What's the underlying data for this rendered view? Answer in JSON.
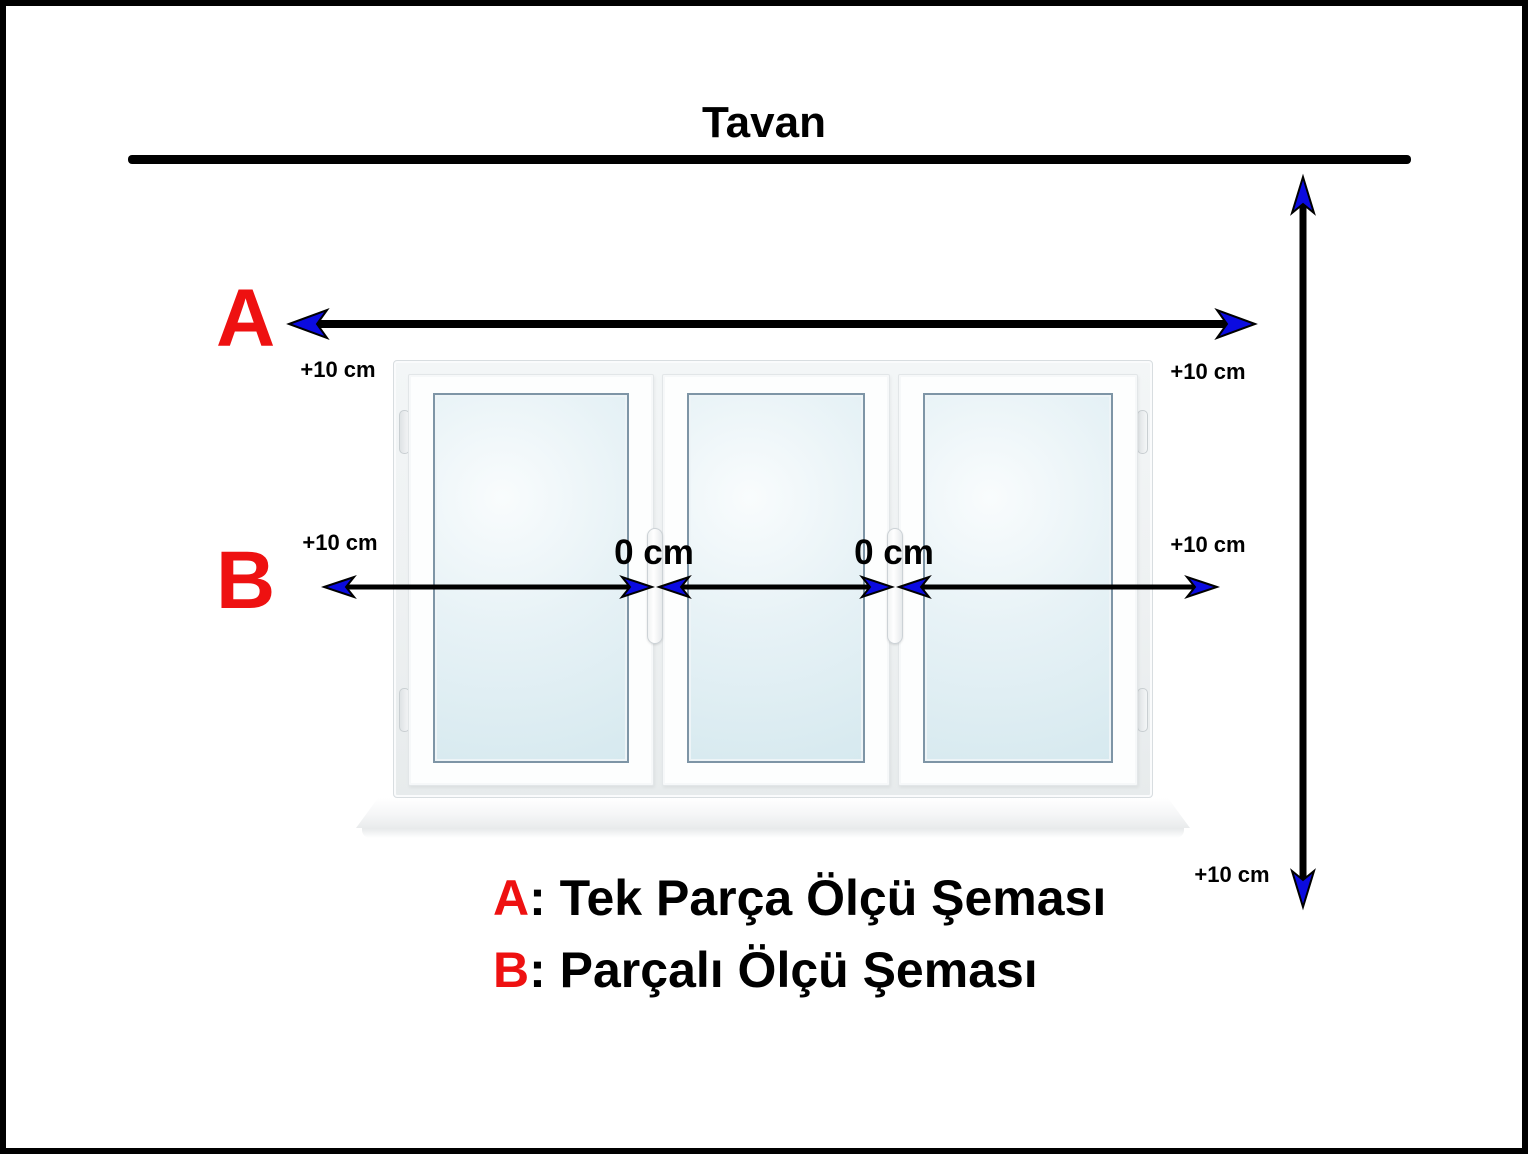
{
  "title": "Tavan",
  "colors": {
    "accent_red": "#ee1111",
    "arrow_blue": "#0b0be0",
    "line_black": "#000000",
    "glass_blue": "#d6e9ef"
  },
  "schema_a": {
    "letter": "A",
    "left_label": "+10 cm",
    "right_label": "+10 cm"
  },
  "schema_b": {
    "letter": "B",
    "left_label": "+10 cm",
    "right_label": "+10 cm",
    "gap_labels": [
      "0 cm",
      "0 cm"
    ]
  },
  "vertical_measure": {
    "bottom_label": "+10 cm"
  },
  "legend": {
    "items": [
      {
        "letter": "A",
        "description": ": Tek Parça Ölçü Şeması"
      },
      {
        "letter": "B",
        "description": ": Parçalı Ölçü Şeması"
      }
    ]
  }
}
